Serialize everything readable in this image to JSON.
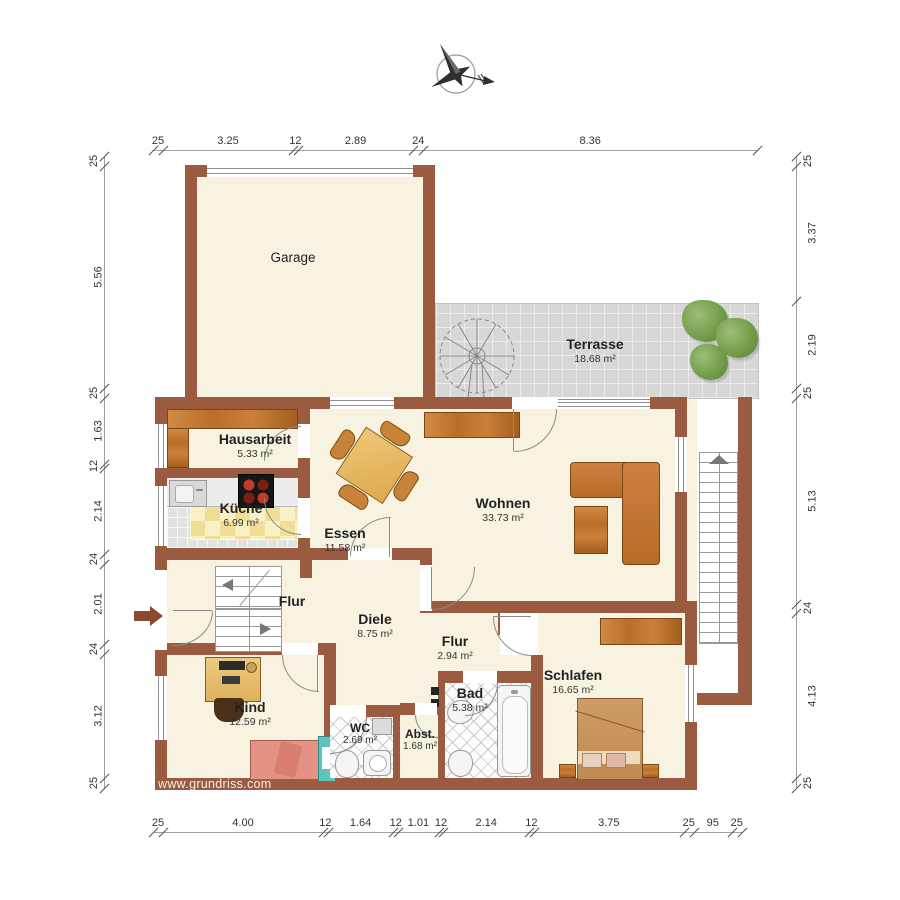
{
  "watermark": "www.grundriss.com",
  "rooms": {
    "garage": {
      "name": "Garage"
    },
    "terrasse": {
      "name": "Terrasse",
      "area": "18.68 m²"
    },
    "hausarbeit": {
      "name": "Hausarbeit",
      "area": "5.33 m²"
    },
    "kueche": {
      "name": "Küche",
      "area": "6.99 m²"
    },
    "essen": {
      "name": "Essen",
      "area": "11.58 m²"
    },
    "wohnen": {
      "name": "Wohnen",
      "area": "33.73 m²"
    },
    "flur": {
      "name": "Flur"
    },
    "diele": {
      "name": "Diele",
      "area": "8.75 m²"
    },
    "flur2": {
      "name": "Flur",
      "area": "2.94 m²"
    },
    "kind": {
      "name": "Kind",
      "area": "12.59 m²"
    },
    "wc": {
      "name": "WC",
      "area": "2.69 m²"
    },
    "abstell": {
      "name": "Abst.",
      "area": "1.68 m²"
    },
    "bad": {
      "name": "Bad",
      "area": "5.38 m²"
    },
    "schlafen": {
      "name": "Schlafen",
      "area": "16.65 m²"
    }
  },
  "dimensions": {
    "top": [
      "25",
      "3.25",
      "12",
      "2.89",
      "24",
      "8.36"
    ],
    "bottom": [
      "25",
      "4.00",
      "12",
      "1.64",
      "12",
      "1.01",
      "12",
      "2.14",
      "12",
      "3.75",
      "25",
      "95",
      "25"
    ],
    "left": [
      "25",
      "5.56",
      "25",
      "1.63",
      "12",
      "2.14",
      "24",
      "2.01",
      "24",
      "3.12",
      "25"
    ],
    "right": [
      "25",
      "3.37",
      "2.19",
      "25",
      "5.13",
      "24",
      "4.13",
      "25"
    ]
  },
  "icons": {
    "compass": "compass-rose",
    "entrance": "entrance-arrow"
  },
  "colors": {
    "wall": "#9b5b41",
    "floor": "#f8f3e1",
    "terrace": "#d7d7d7",
    "wood": "#c47c35",
    "kitchen_tile": "#f0dd96",
    "bed_kind": "#e59286",
    "frame_teal": "#5ec4bd",
    "plant_green": "#6f9c48"
  }
}
